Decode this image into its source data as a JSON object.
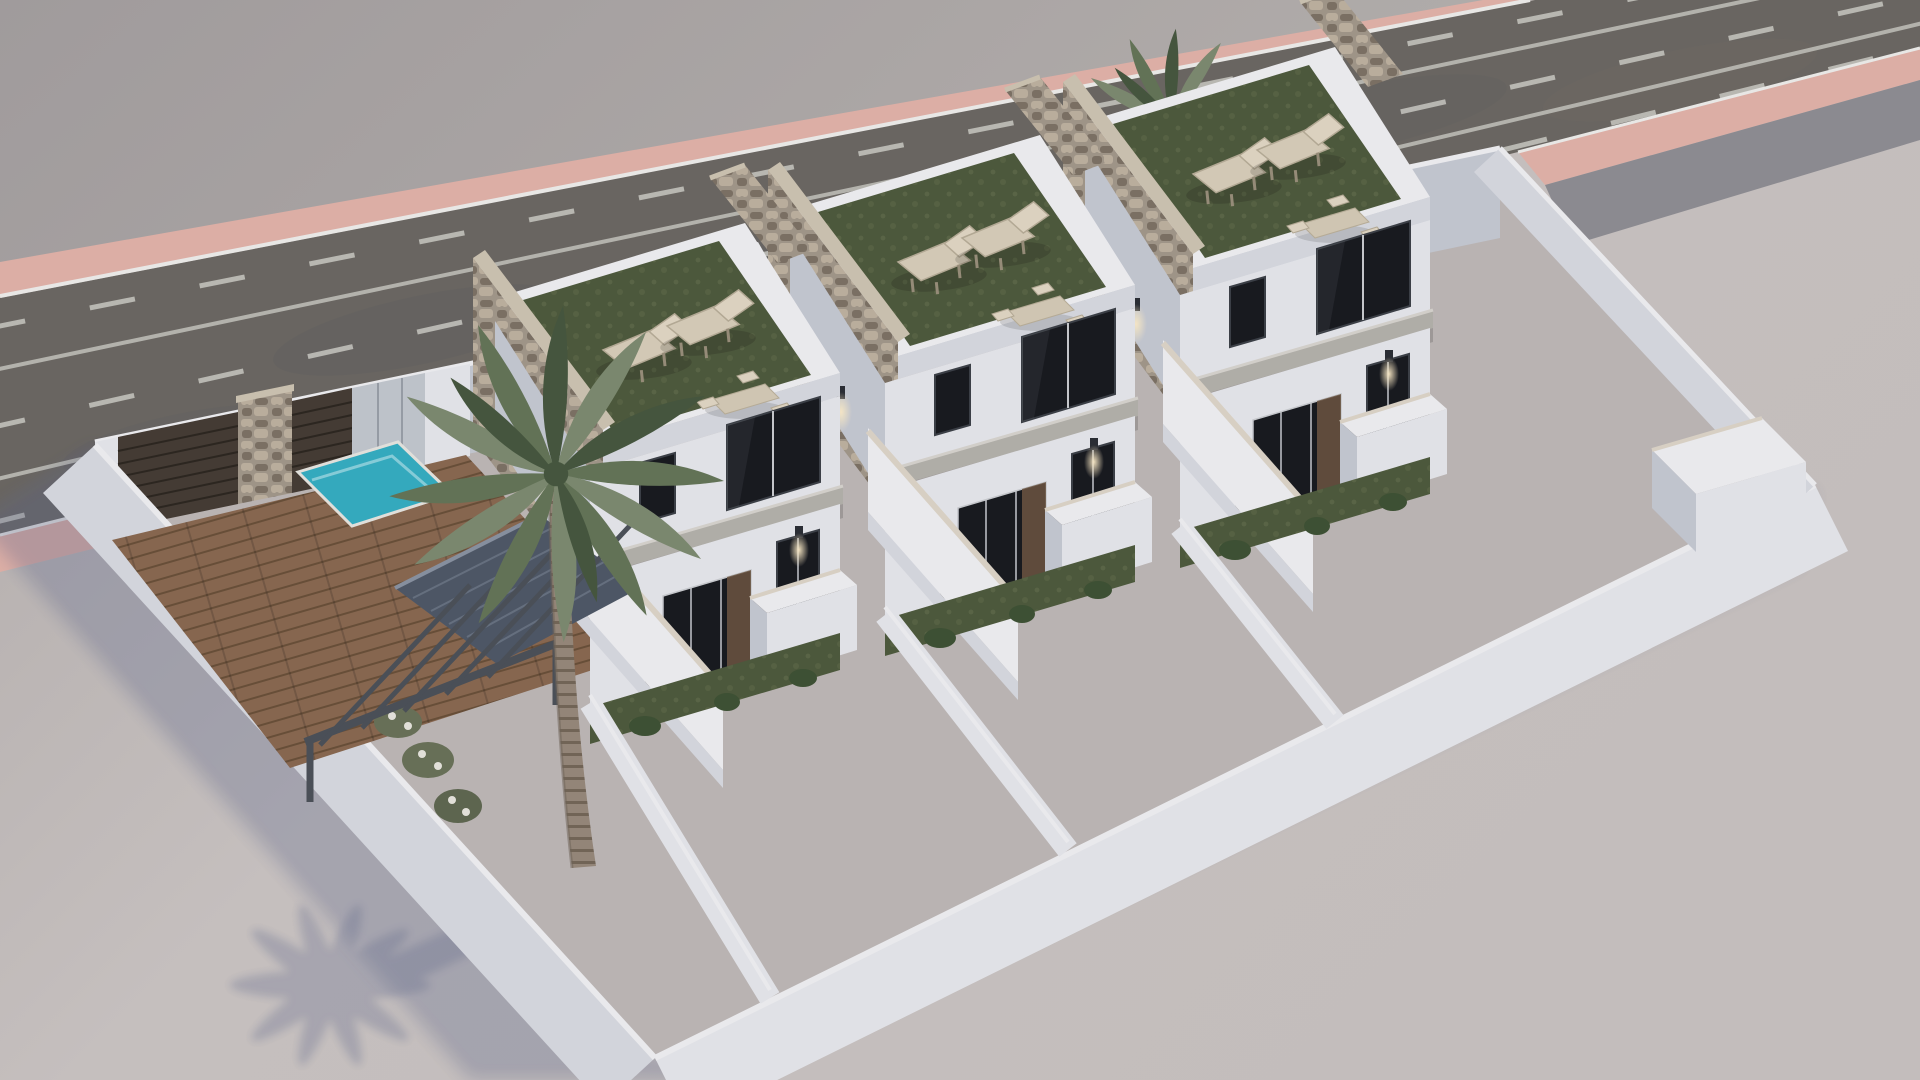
{
  "scene": {
    "type": "3d-architectural-render",
    "subject": "aerial dusk view of three attached modern white townhouses with roof solariums inside a walled plot beside a road",
    "houses": 3,
    "roof_loungers_per_house": 2,
    "roof_dining_sets_per_house": 1,
    "swimming_pools": 1,
    "palm_trees": 2,
    "vehicles_on_road": 1,
    "road_lane_line_rows": 5,
    "wall_sconces_lit": true,
    "perimeter": "white rendered wall with dark slatted entrance gate and stone pillars",
    "roof_surface": "artificial turf",
    "feature_walls": "rough stone cladding",
    "shadow_direction": "lower-left"
  },
  "palette": {
    "groundFar": "#a9a4a3",
    "ground": "#c8c2c0",
    "groundInner": "#bfb9b7",
    "road": "#6c6862",
    "roadBlotch": "#585a63",
    "roadLine": "#ccccc5",
    "curbPink": "#e3b3a9",
    "curbWhite": "#f0efec",
    "sidewalk": "#8f8e93",
    "wallBright": "#f1f1f3",
    "wallLight": "#e8e9ed",
    "wallMid": "#d9dbe1",
    "wallShade": "#c6cad3",
    "wallDark": "#b7bbc7",
    "coping": "#ded6c8",
    "copingStone": "#cfc5b2",
    "stone": "#a3988a",
    "stoneLight": "#bfb2a0",
    "stoneDark": "#7d7264",
    "turf": "#4e5a3c",
    "turfLight": "#66714e",
    "glass": "#17191e",
    "glassFrame": "#caccd0",
    "interiorWarm": "#6f5742",
    "deck": "#8a6950",
    "deckLine": "#6a5038",
    "pool": "#35aec2",
    "poolRim": "#9fdbe4",
    "gateSlat": "#453c34",
    "gateSlatDark": "#2c261f",
    "grayPanel": "#c3c8cf",
    "canopy": "#b5b2ab",
    "awning": "#4f5866",
    "awningRidge": "#6b7585",
    "pergola": "#4b5158",
    "lounger": "#d9cfba",
    "loungerBack": "#e2d8c4",
    "tableTop": "#d6cbb7",
    "trunk": "#97897a",
    "trunkRing": "#746757",
    "frond": "#647557",
    "frondLight": "#7d8b70",
    "frondDark": "#46573e",
    "carBody": "#eef0f2",
    "shadow": "#5e688c",
    "glow": "#ffeec9",
    "plantDark": "#3e5233"
  }
}
